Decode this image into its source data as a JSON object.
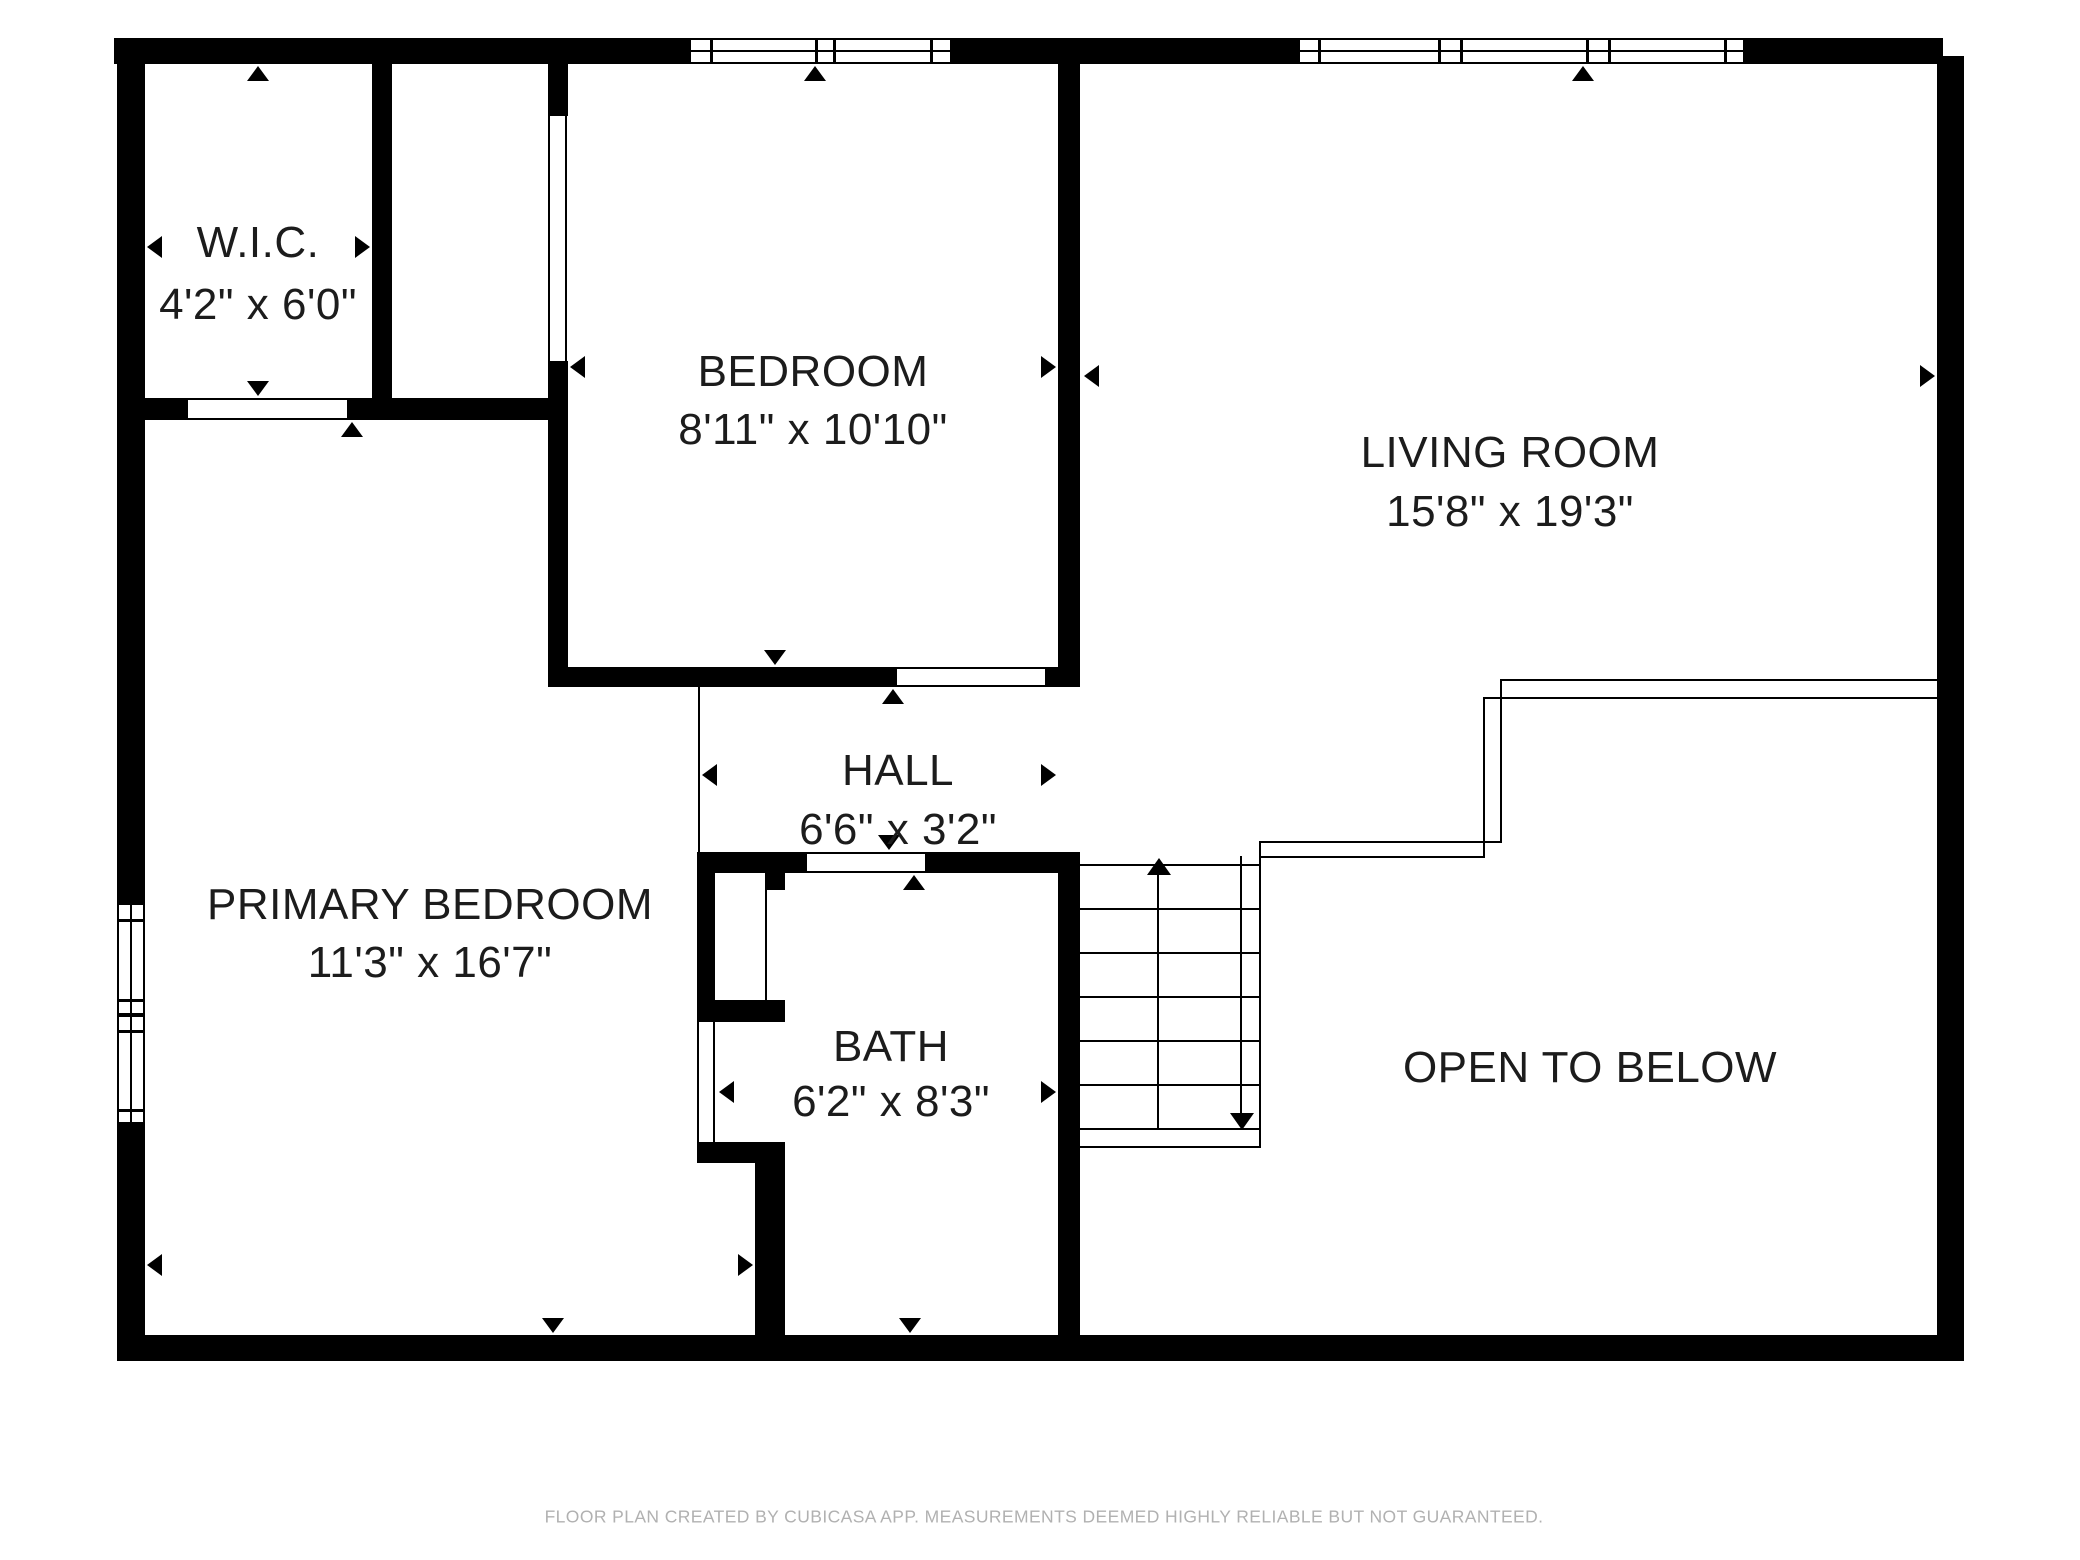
{
  "floorplan": {
    "app_name": "CUBICASA",
    "rooms": [
      {
        "id": "wic",
        "label": "W.I.C.",
        "dimensions": "4'2\" x 6'0\""
      },
      {
        "id": "bedroom",
        "label": "BEDROOM",
        "dimensions": "8'11\" x 10'10\""
      },
      {
        "id": "living_room",
        "label": "LIVING ROOM",
        "dimensions": "15'8\" x 19'3\""
      },
      {
        "id": "primary_bedroom",
        "label": "PRIMARY BEDROOM",
        "dimensions": "11'3\" x 16'7\""
      },
      {
        "id": "hall",
        "label": "HALL",
        "dimensions": "6'6\" x 3'2\""
      },
      {
        "id": "bath",
        "label": "BATH",
        "dimensions": "6'2\" x 8'3\""
      },
      {
        "id": "open_to_below",
        "label": "OPEN TO BELOW",
        "dimensions": ""
      }
    ],
    "stairs": {
      "direction_up": "up",
      "direction_down": "down",
      "tread_count": 7
    },
    "footer_disclaimer": "FLOOR PLAN CREATED BY CUBICASA APP. MEASUREMENTS DEEMED HIGHLY RELIABLE BUT NOT GUARANTEED.",
    "colors": {
      "wall": "#000000",
      "background": "#ffffff",
      "label_text": "#1c1c1c",
      "footer_text": "#b1b1b1"
    }
  }
}
